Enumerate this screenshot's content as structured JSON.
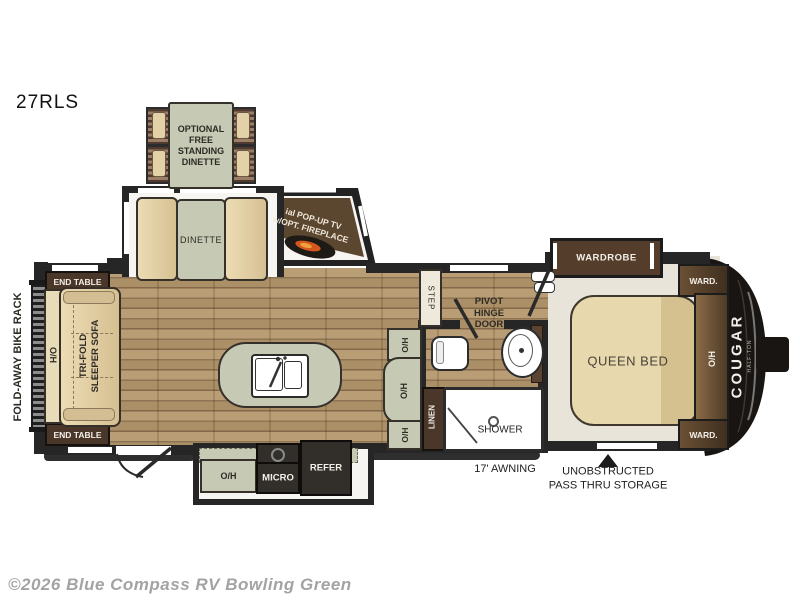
{
  "model": "27RLS",
  "plan": {
    "optional_dinette_lines": [
      "OPTIONAL",
      "FREE",
      "STANDING",
      "DINETTE"
    ],
    "dinette": "DINETTE",
    "tv_lines": [
      "POP-UP TV",
      "w/OPT. FIREPLACE"
    ],
    "end_table": "END TABLE",
    "bike_rack": "FOLD-AWAY BIKE RACK",
    "oh": "O/H",
    "sofa_lines": [
      "TRI-FOLD",
      "SLEEPER SOFA"
    ],
    "micro": "MICRO",
    "refer": "REFER",
    "step": "STEP",
    "pivot_lines": [
      "PIVOT",
      "HINGE",
      "DOOR"
    ],
    "linen": "LINEN",
    "shower": "SHOWER",
    "wardrobe": "WARDROBE",
    "ward": "WARD.",
    "queen_bed": "QUEEN BED",
    "awning": "17' AWNING",
    "pass_thru_lines": [
      "UNOBSTRUCTED",
      "PASS THRU STORAGE"
    ],
    "cap_logo": "COUGAR",
    "cap_sub": "HALF-TON"
  },
  "footer": {
    "copyright": "©2026 Blue Compass RV Bowling Green"
  },
  "colors": {
    "wall": "#262626",
    "wood_dark": "#8f7454",
    "wood_light": "#b89d75",
    "sage": "#c6cab4",
    "tan": "#ddc89c",
    "dark_brown": "#4a3729",
    "appliance": "#322e2a",
    "flame": "#e06a1f",
    "cap": "#181512"
  }
}
